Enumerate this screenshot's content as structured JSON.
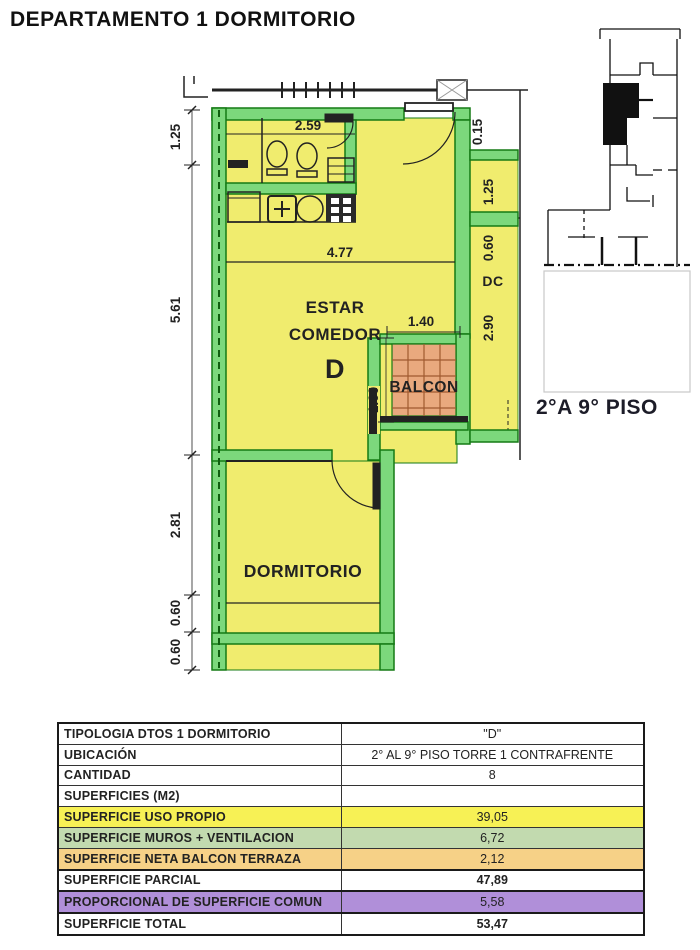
{
  "title": "DEPARTAMENTO 1 DORMITORIO",
  "colors": {
    "room-fill": "#F0EC6E",
    "wall-fill": "#7CD87C",
    "wall-line": "#157A15",
    "tile-fill": "#E9A97E",
    "tile-line": "#A05A30"
  },
  "floorplan": {
    "rooms": {
      "estar_line1": "ESTAR",
      "estar_line2": "COMEDOR",
      "unit_letter": "D",
      "balcony": "BALCON",
      "bedroom": "DORMITORIO",
      "adjacent_unit": "DC"
    },
    "dims": {
      "bath_width": "2.59",
      "living_width": "4.77",
      "balcony_width": "1.40",
      "balcony_depth": "1.60",
      "left_1": "1.25",
      "left_2": "5.61",
      "left_3": "2.81",
      "left_4": "0.60",
      "left_5": "0.60",
      "right_1": "0.15",
      "right_2": "1.25",
      "right_3": "0.60",
      "right_4": "2.90"
    }
  },
  "keyplan": {
    "caption": "2°A 9° PISO"
  },
  "table": {
    "rows": [
      {
        "label": "TIPOLOGIA  DTOS 1 DORMITORIO",
        "value": "\"D\"",
        "bg": "#FFFFFF"
      },
      {
        "label": "UBICACIÓN",
        "value": "2° AL 9° PISO  TORRE 1 CONTRAFRENTE",
        "bg": "#FFFFFF"
      },
      {
        "label": "CANTIDAD",
        "value": "8",
        "bg": "#FFFFFF"
      },
      {
        "label": "SUPERFICIES (M2)",
        "value": "",
        "bg": "#FFFFFF"
      },
      {
        "label": "SUPERFICIE USO PROPIO",
        "value": "39,05",
        "bg": "#F7F155"
      },
      {
        "label": "SUPERFICIE MUROS + VENTILACION",
        "value": "6,72",
        "bg": "#C2DAAF"
      },
      {
        "label": "SUPERFICIE NETA BALCON TERRAZA",
        "value": "2,12",
        "bg": "#F6D187"
      },
      {
        "label": "SUPERFICIE PARCIAL",
        "value": "47,89",
        "bg": "#FFFFFF"
      },
      {
        "label": "PROPORCIONAL DE SUPERFICIE COMUN",
        "value": "5,58",
        "bg": "#B08FD9"
      },
      {
        "label": "SUPERFICIE TOTAL",
        "value": "53,47",
        "bg": "#FFFFFF"
      }
    ]
  }
}
